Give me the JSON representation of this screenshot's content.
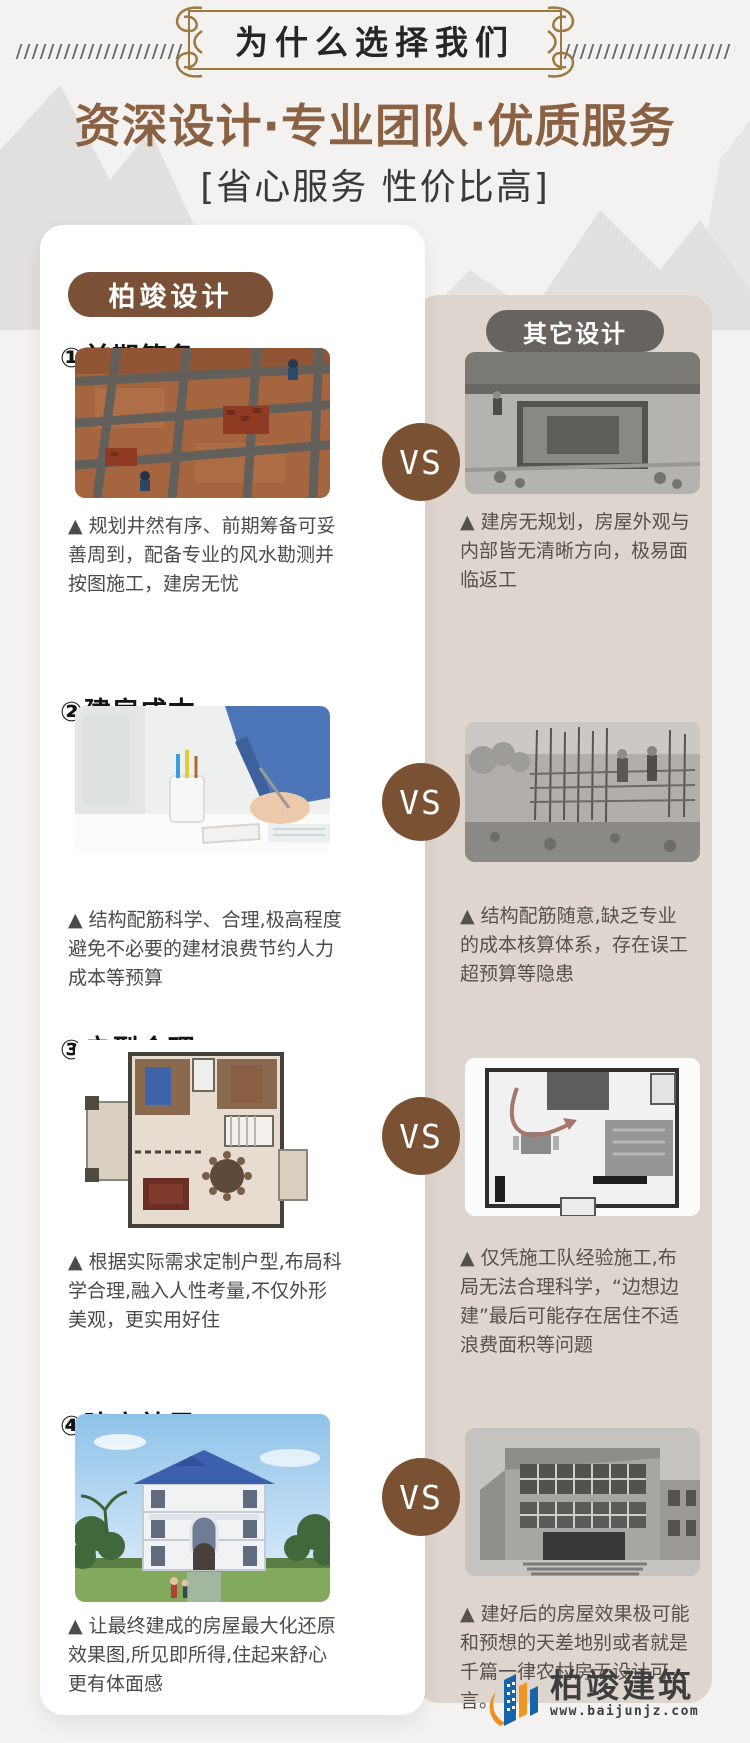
{
  "header": {
    "ribbon_title": "为什么选择我们",
    "title": "资深设计·专业团队·优质服务",
    "subtitle": "[省心服务 性价比高]"
  },
  "comparison": {
    "left_badge": "柏竣设计",
    "right_badge": "其它设计",
    "vs_label": "VS"
  },
  "sections": [
    {
      "title": "①前期筹备",
      "left_caption": "▲ 规划井然有序、前期筹备可妥善周到，配备专业的风水勘测并按图施工，建房无忧",
      "right_caption": "▲ 建房无规划，房屋外观与内部皆无清晰方向，极易面临返工"
    },
    {
      "title": "②建房成本",
      "left_caption": "▲ 结构配筋科学、合理,极高程度避免不必要的建材浪费节约人力成本等预算",
      "right_caption": "▲ 结构配筋随意,缺乏专业的成本核算体系，存在误工超预算等隐患"
    },
    {
      "title": "③户型合理",
      "left_caption": "▲ 根据实际需求定制户型,布局科学合理,融入人性考量,不仅外形美观，更实用好住",
      "right_caption": "▲ 仅凭施工队经验施工,布局无法合理科学，“边想边建”最后可能存在居住不适浪费面积等问题"
    },
    {
      "title": "④建房效果",
      "left_caption": "▲ 让最终建成的房屋最大化还原效果图,所见即所得,住起来舒心更有体面感",
      "right_caption": "▲ 建好后的房屋效果极可能和预想的天差地别或者就是千篇一律农村房无设计可言。"
    }
  ],
  "footer_logo": {
    "name": "柏竣建筑",
    "website": "www.baijunjz.com"
  },
  "colors": {
    "page_background": "#f3f2f0",
    "title_brown": "#8a6243",
    "frame_gold": "#9b7940",
    "baijun_badge": "#7a5136",
    "other_badge": "#696360",
    "vs_circle": "#7a5233",
    "other_card": "#ded6ce",
    "logo_blue": "#1565a8",
    "logo_orange": "#f0951e"
  }
}
